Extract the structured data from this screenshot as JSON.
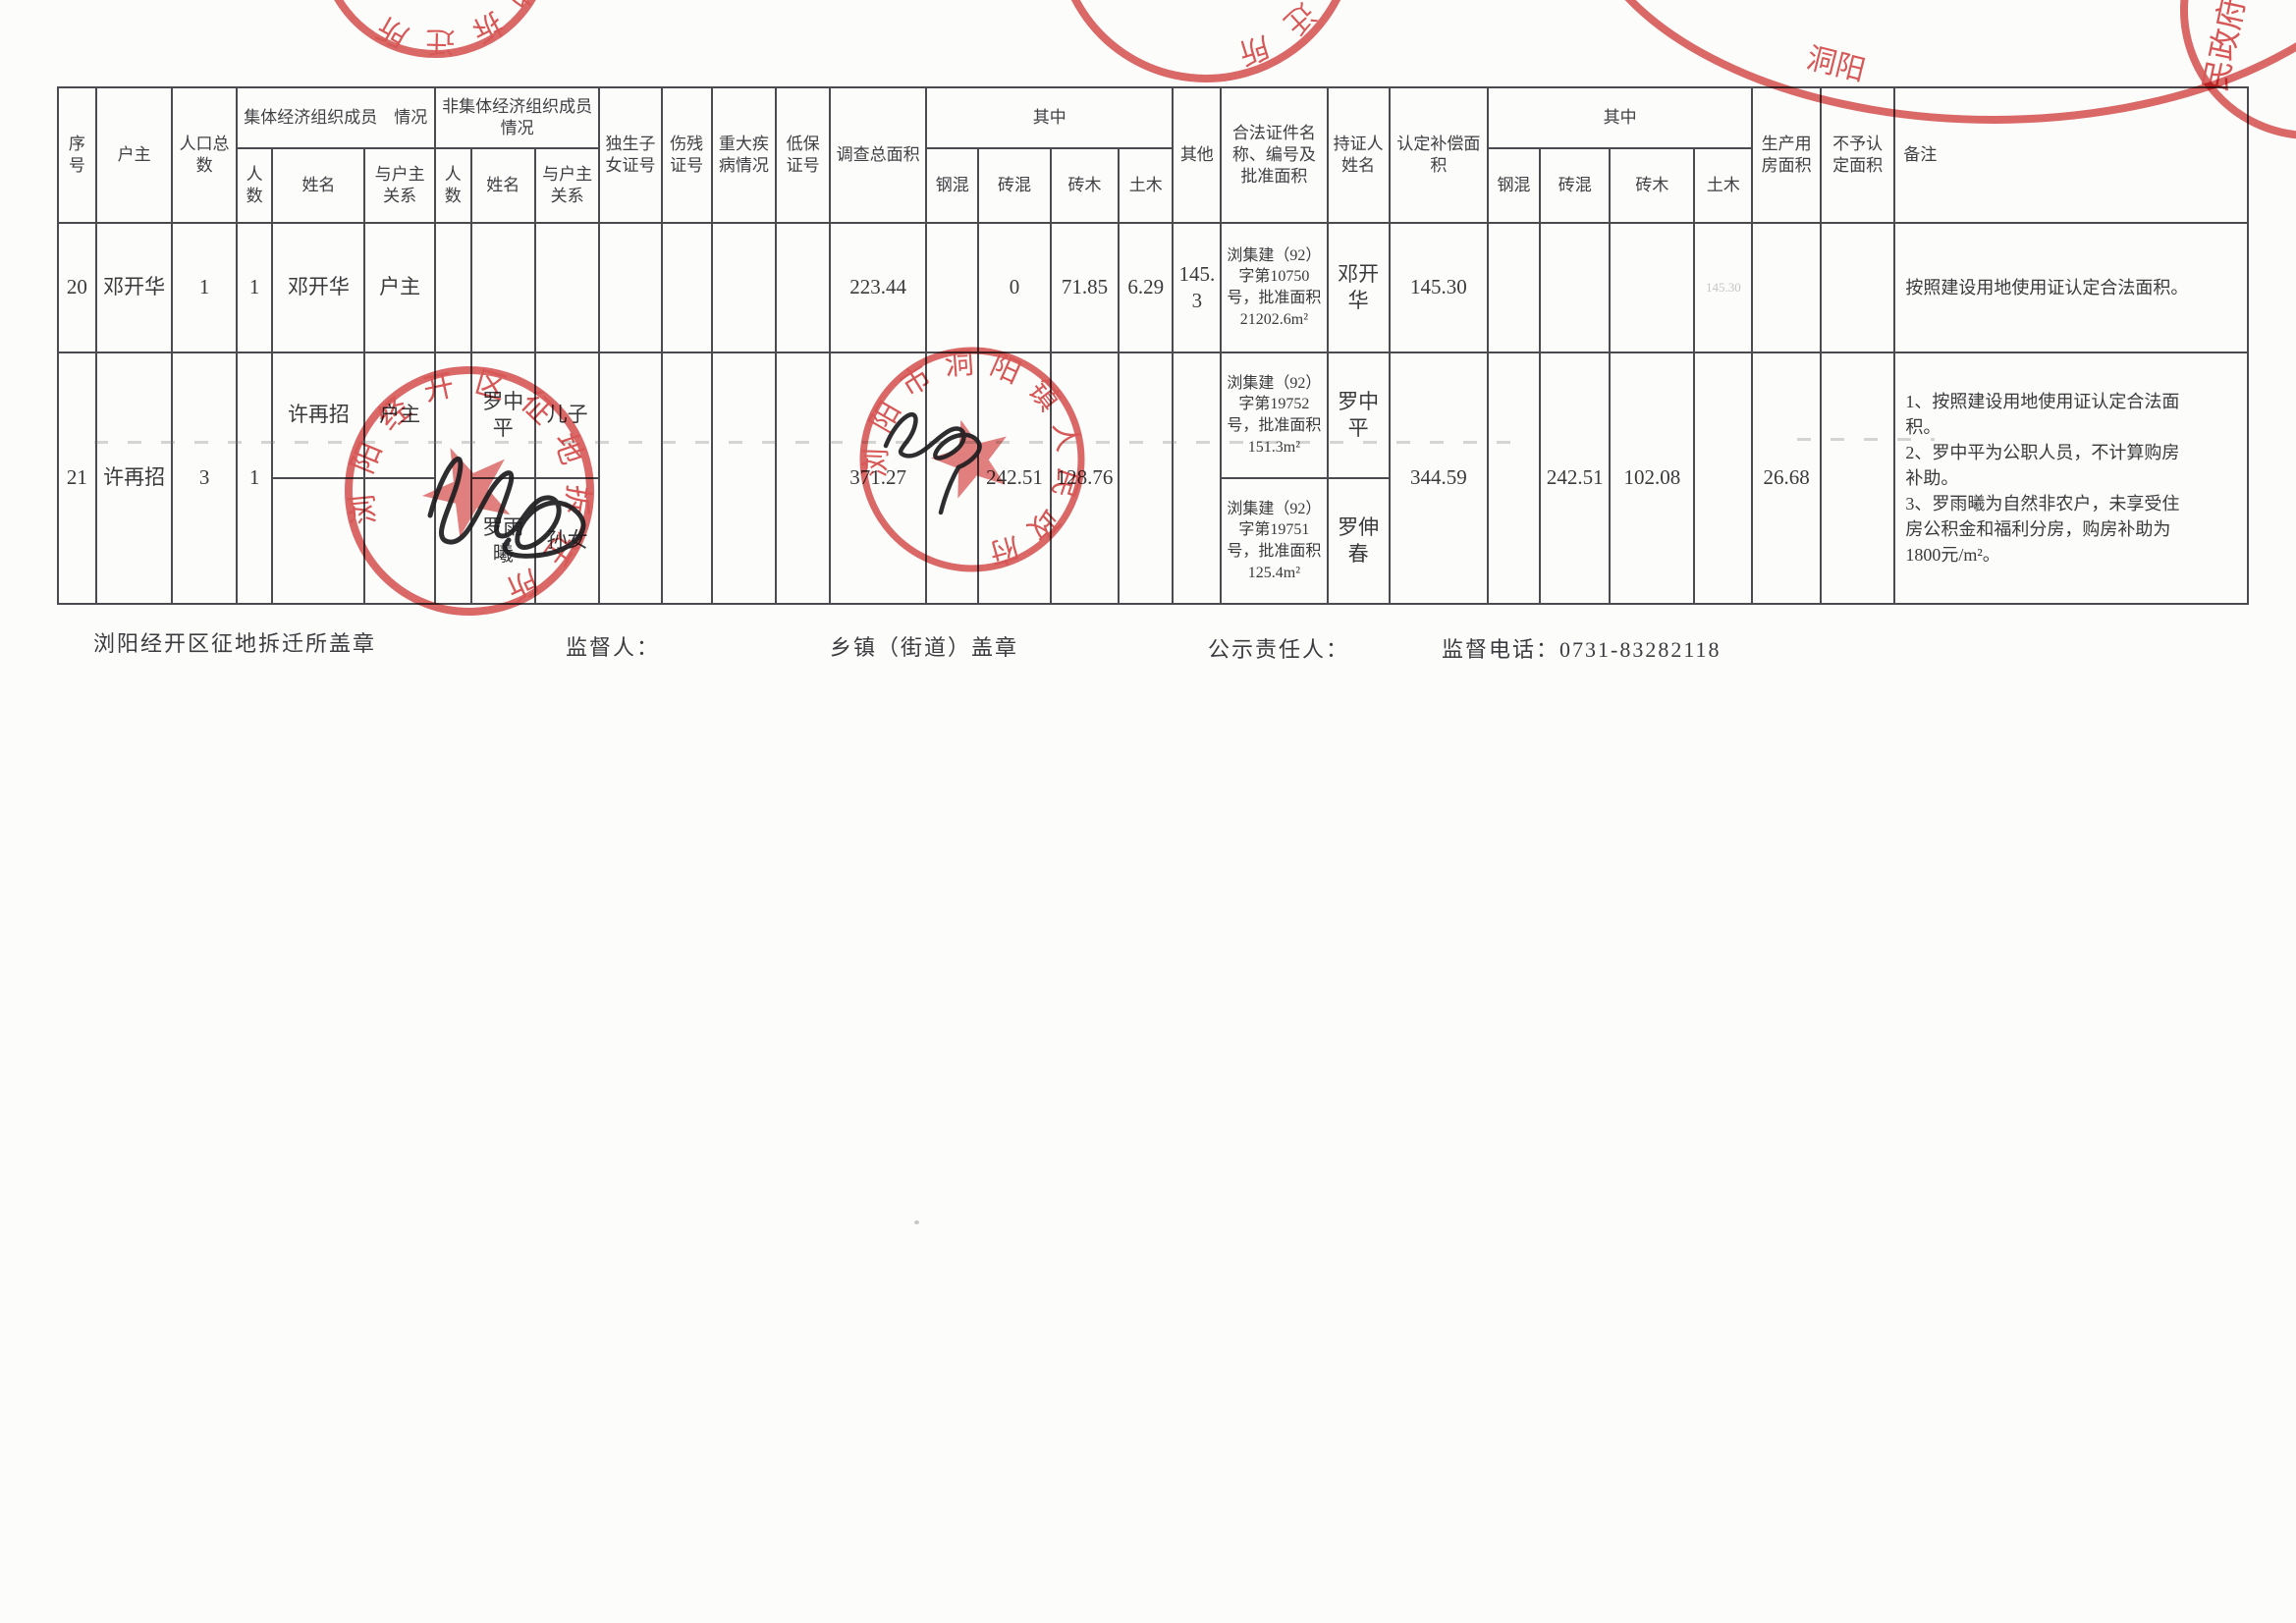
{
  "table": {
    "headers": {
      "seq": "序号",
      "household_head": "户主",
      "population_total": "人口总数",
      "collective_group": "集体经济组织成员　情况",
      "non_collective_group": "非集体经济组织成员　情况",
      "count": "人数",
      "name": "姓名",
      "relation": "与户主关系",
      "only_child_cert": "独生子女证号",
      "disability_cert": "伤残证号",
      "major_illness": "重大疾病情况",
      "subsistence_cert": "低保证号",
      "survey_total_area": "调查总面积",
      "including": "其中",
      "steel_concrete": "钢混",
      "brick_concrete": "砖混",
      "brick_wood": "砖木",
      "earth_wood": "土木",
      "other": "其他",
      "legal_cert": "合法证件名称、编号及批准面积",
      "cert_holder": "持证人姓名",
      "approved_comp_area": "认定补偿面积",
      "production_area": "生产用房面积",
      "excluded_area": "不予认定面积",
      "remarks": "备注"
    },
    "row20": {
      "seq": "20",
      "head": "邓开华",
      "population": "1",
      "collective_count": "1",
      "collective_name": "邓开华",
      "collective_relation": "户主",
      "survey_total": "223.44",
      "survey_brick_concrete": "0",
      "survey_brick_wood": "71.85",
      "survey_earth_wood": "6.29",
      "survey_other": "145.3",
      "cert": "浏集建（92）字第10750号，批准面积21202.6m²",
      "holder": "邓开华",
      "approved_total": "145.30",
      "approved_earth_wood_faint": "145.30",
      "remark": "按照建设用地使用证认定合法面积。"
    },
    "row21": {
      "seq": "21",
      "head": "许再招",
      "population": "3",
      "collective_count": "1",
      "sub1": {
        "collective_name": "许再招",
        "collective_relation": "户主",
        "noncollective_name": "罗中平",
        "noncollective_relation": "儿子",
        "cert": "浏集建（92）字第19752号，批准面积151.3m²",
        "holder": "罗中平"
      },
      "sub2": {
        "noncollective_name": "罗雨曦",
        "noncollective_relation": "孙女",
        "cert": "浏集建（92）字第19751号，批准面积125.4m²",
        "holder": "罗伸春"
      },
      "survey_total": "371.27",
      "survey_brick_concrete": "242.51",
      "survey_brick_wood": "128.76",
      "approved_total": "344.59",
      "approved_brick_concrete": "242.51",
      "approved_brick_wood": "102.08",
      "production_area": "26.68",
      "remark": "1、按照建设用地使用证认定合法面\n积。\n2、罗中平为公职人员，不计算购房\n补助。\n3、罗雨曦为自然非农户，未享受住\n房公积金和福利分房，购房补助为\n1800元/m²。"
    }
  },
  "footer": {
    "left_seal_label": "浏阳经开区征地拆迁所盖章",
    "supervisor_label": "监督人：",
    "township_seal_label": "乡镇（街道）盖章",
    "publicity_person_label": "公示责任人：",
    "hotline_label": "监督电话：",
    "hotline_number": "0731-83282118"
  },
  "stamps": {
    "red": "#d23a3a",
    "town_government_seal": "浏阳市洞阳镇人民政府",
    "expropriation_office_seal": "浏阳经开区征地拆迁所",
    "fragment_chars_header": "洞阳",
    "fragment_chars_corner": "民政府"
  }
}
